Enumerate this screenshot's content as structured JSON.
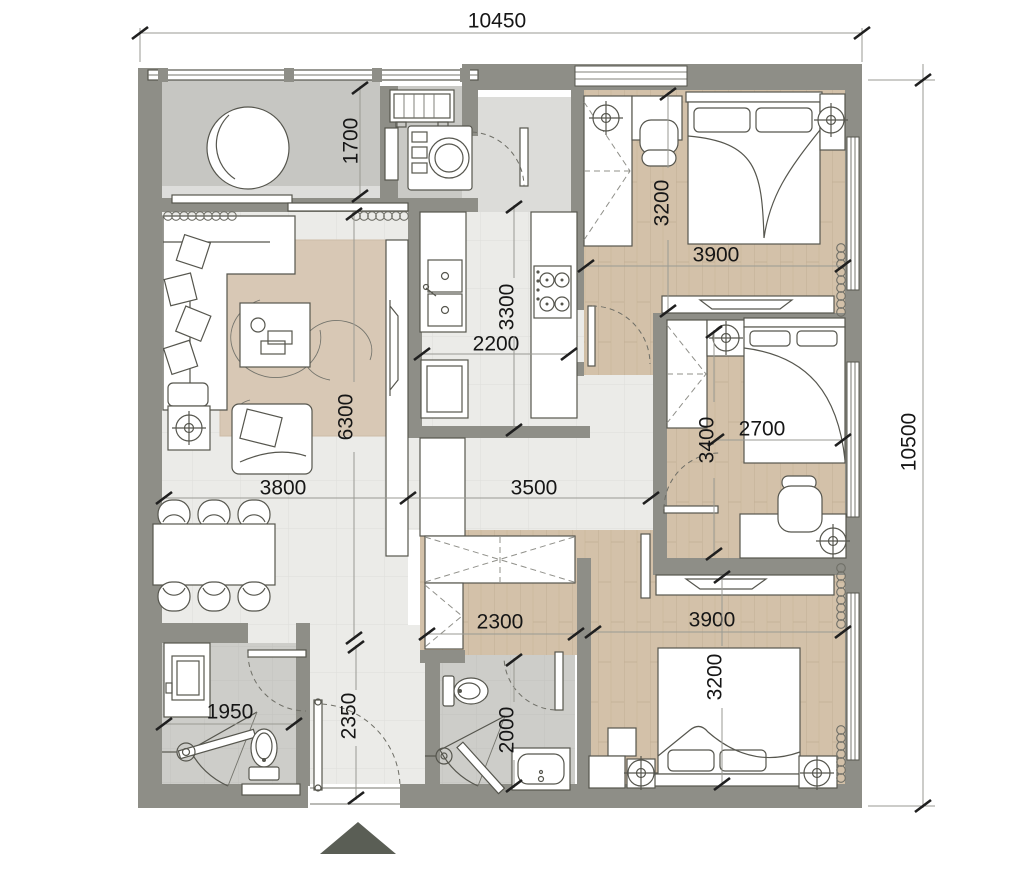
{
  "plan": {
    "overall": {
      "width_label": "10450",
      "height_label": "10500"
    },
    "dim_labels": {
      "balcony_depth": "1700",
      "bedroom2_width": "3200",
      "bedroom2_length": "3900",
      "kitchen_width": "2200",
      "kitchen_length": "3300",
      "living_length": "6300",
      "living_width": "3800",
      "hall_width": "3500",
      "bedroom3_width": "2700",
      "bedroom3_length": "3400",
      "closet_width": "2300",
      "master_length": "3900",
      "master_width": "3200",
      "bath1_width": "1950",
      "entry_length": "2350",
      "bath2_length": "2000"
    },
    "colors": {
      "wall": "#8e8e87",
      "wood_floor": "#d3c1a9",
      "tile_floor": "#ebebe8",
      "bath_floor": "#cdcdc9",
      "balcony_floor": "#c6c6c2",
      "rug": "#d8c8b5",
      "outline": "#56564e",
      "dimension_text": "#161616",
      "entry_marker": "#5a5e55"
    },
    "icons": {
      "entry_arrow": "entrance-direction-marker",
      "lamp": "ceiling-lamp-symbol"
    }
  }
}
